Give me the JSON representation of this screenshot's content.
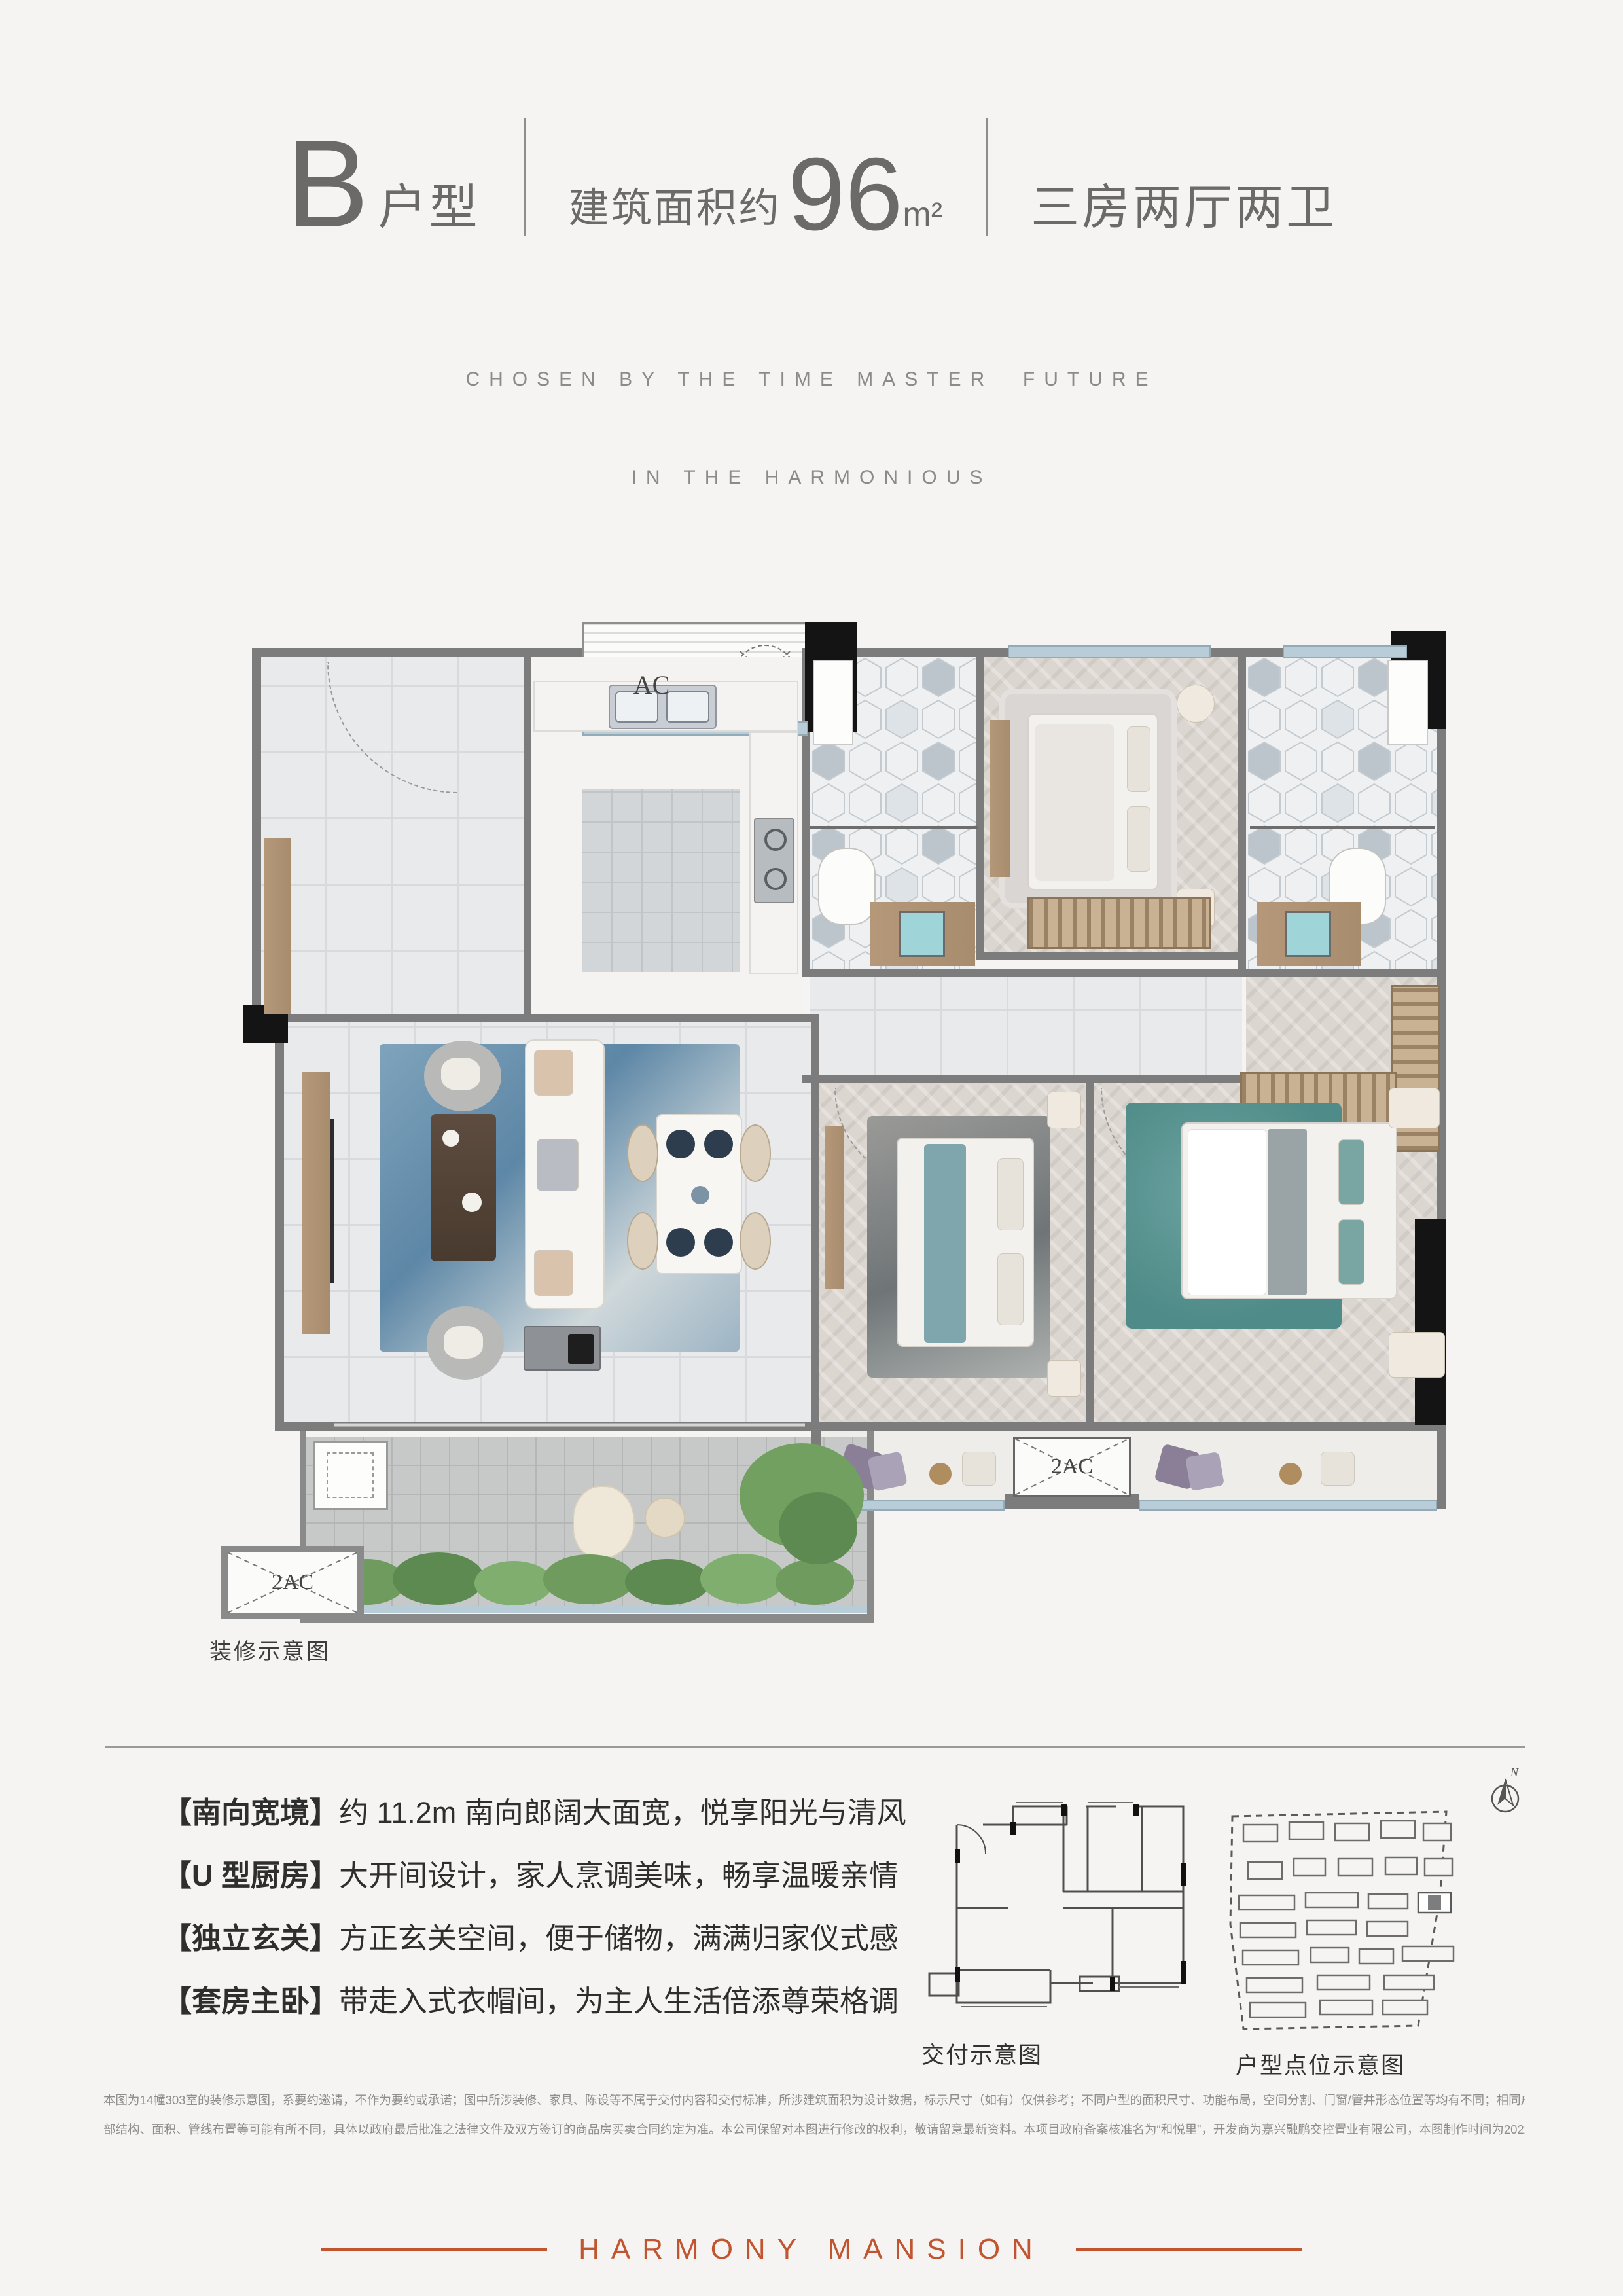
{
  "header": {
    "unit_letter": "B",
    "unit_suffix": "户型",
    "area_prefix": "建筑面积约",
    "area_value": "96",
    "area_unit": "m²",
    "rooms_text": "三房两厅两卫",
    "subtitle_line1": "CHOSEN BY THE TIME MASTER  FUTURE",
    "subtitle_line2": "IN THE HARMONIOUS"
  },
  "plan": {
    "caption": "装修示意图",
    "ac_label": "AC",
    "ac2_label_bay": "2AC",
    "ac2_label_balcony": "2AC"
  },
  "features": {
    "items": [
      {
        "tag": "【南向宽境】",
        "desc": "约 11.2m 南向郎阔大面宽，悦享阳光与清风"
      },
      {
        "tag": "【U 型厨房】",
        "desc": "大开间设计，家人烹调美味，畅享温暖亲情"
      },
      {
        "tag": "【独立玄关】",
        "desc": "方正玄关空间，便于储物，满满归家仪式感"
      },
      {
        "tag": "【套房主卧】",
        "desc": "带走入式衣帽间，为主人生活倍添尊荣格调"
      }
    ]
  },
  "diagrams": {
    "delivery_caption": "交付示意图",
    "siteplan_caption": "户型点位示意图",
    "compass_label": "N"
  },
  "disclaimer": {
    "line1": "本图为14幢303室的装修示意图，系要约邀请，不作为要约或承诺；图中所涉装修、家具、陈设等不属于交付内容和交付标准，所涉建筑面积为设计数据，标示尺寸（如有）仅供参考；不同户型的面积尺寸、功能布局，空间分割、门窗/管井形态位置等均有不同；相同户型因楼栋、楼层、单元不同，局",
    "line2": "部结构、面积、管线布置等可能有所不同，具体以政府最后批准之法律文件及双方签订的商品房买卖合同约定为准。本公司保留对本图进行修改的权利，敬请留意最新资料。本项目政府备案核准名为“和悦里”，开发商为嘉兴融鹏交控置业有限公司，本图制作时间为2022年6月，有效期1个月。"
  },
  "footer": {
    "brand": "HARMONY MANSION"
  },
  "colors": {
    "accent": "#c0552f",
    "title_gray": "#6b6a68",
    "wall_gray": "#7c7c7c",
    "window_blue": "#b9cdd9"
  }
}
